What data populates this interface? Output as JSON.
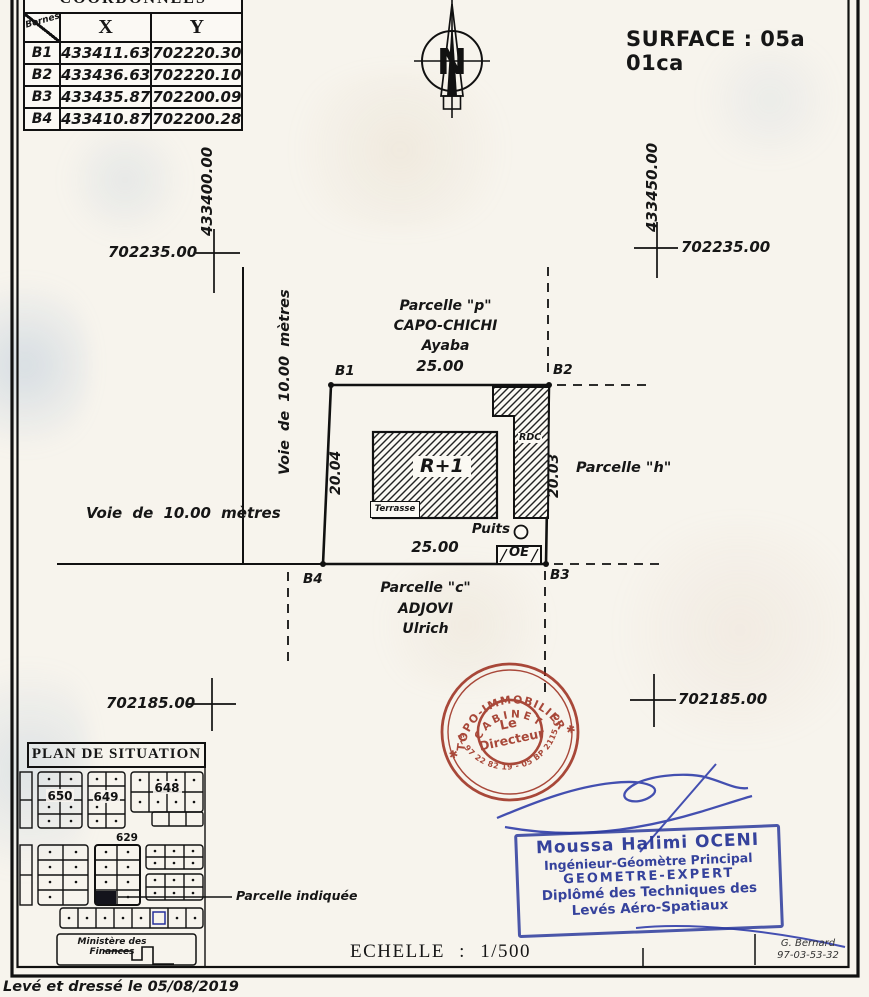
{
  "document": {
    "surface_label": "SURFACE : 05a 01ca",
    "scale_label": "ECHELLE : 1/500",
    "survey_note": "Levé et dressé le 05/08/2019",
    "drafter_name": "G. Bernard",
    "drafter_code": "97-03-53-32"
  },
  "compass": {
    "letter": "N"
  },
  "coordinates_table": {
    "title": "COORDONNEES",
    "corner_label": "Bornes",
    "col_x": "X",
    "col_y": "Y",
    "rows": [
      {
        "borne": "B1",
        "x": "433411.63",
        "y": "702220.30"
      },
      {
        "borne": "B2",
        "x": "433436.63",
        "y": "702220.10"
      },
      {
        "borne": "B3",
        "x": "433435.87",
        "y": "702200.09"
      },
      {
        "borne": "B4",
        "x": "433410.87",
        "y": "702200.28"
      }
    ]
  },
  "grid": {
    "easting_left": "433400.00",
    "easting_right": "433450.00",
    "northing_upper": "702235.00",
    "northing_lower": "702185.00"
  },
  "roads": {
    "west": "Voie de 10.00 mètres",
    "south": "Voie de 10.00 mètres"
  },
  "parcel": {
    "corner_b1": "B1",
    "corner_b2": "B2",
    "corner_b3": "B3",
    "corner_b4": "B4",
    "dim_top": "25.00",
    "dim_bottom": "25.00",
    "dim_left": "20.04",
    "dim_right": "20.03",
    "building_label": "R+1",
    "terrace_label": "Terrasse",
    "rdc_label": "RDC",
    "well_label": "Puits",
    "oe_label": "OE"
  },
  "neighbors": {
    "north_line1": "Parcelle \"p\"",
    "north_line2": "CAPO-CHICHI",
    "north_line3": "Ayaba",
    "east": "Parcelle \"h\"",
    "south_line1": "Parcelle \"c\"",
    "south_line2": "ADJOVI",
    "south_line3": "Ulrich"
  },
  "situation_plan": {
    "title": "PLAN DE SITUATION",
    "block_650": "650",
    "block_649": "649",
    "block_648": "648",
    "block_629": "629",
    "indicated_parcel_label": "Parcelle indiquée",
    "ministry_line1": "Ministère des",
    "ministry_line2": "Finances"
  },
  "stamps": {
    "round": {
      "arc_top": "\"TOPO-IMMOBILIER\"",
      "arc_inner": "CABINET",
      "center_line1": "Le",
      "center_line2": "Directeur",
      "arc_bottom": "TEL 97 22 82 19 - 05 BP 2115 COT",
      "star": "✱",
      "color": "#9c2c1c"
    },
    "rect": {
      "line1": "Moussa Halimi OCENI",
      "line2": "Ingénieur-Géomètre Principal",
      "line3": "GEOMETRE-EXPERT",
      "line4": "Diplômé des Techniques des",
      "line5": "Levés Aéro-Spatiaux",
      "color": "#2b3a9c"
    }
  }
}
